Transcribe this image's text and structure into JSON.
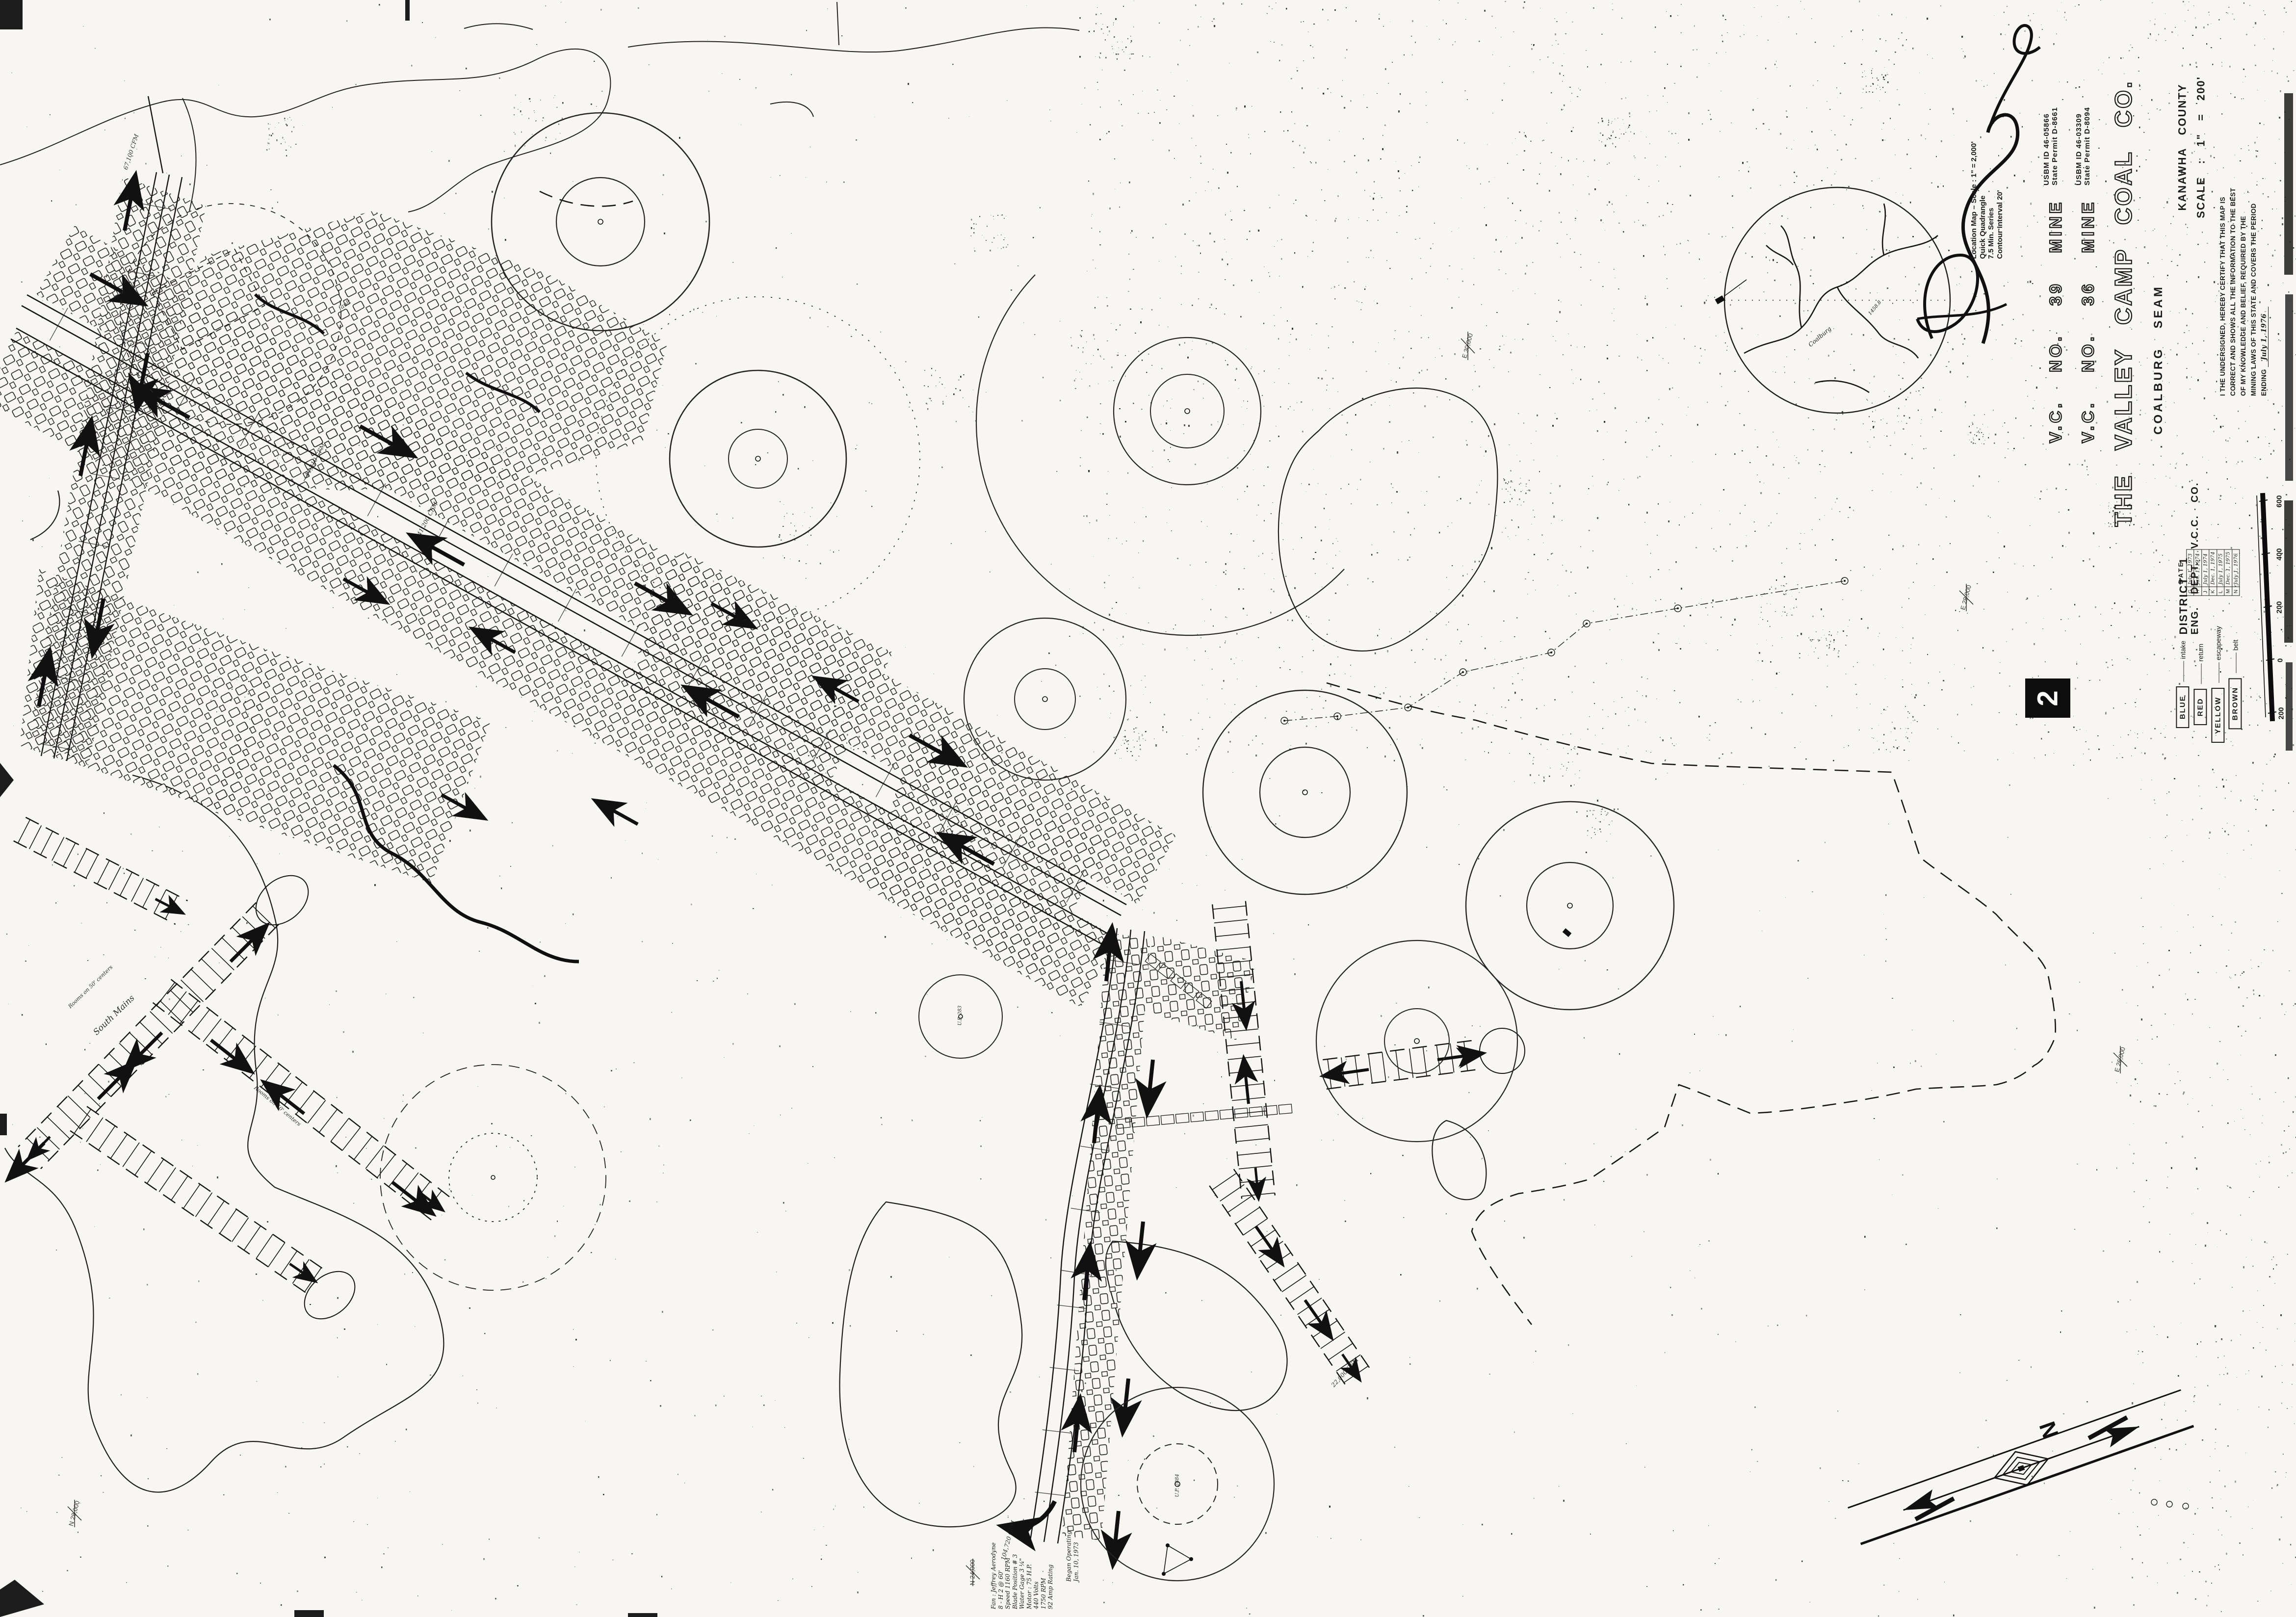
{
  "sheet": {
    "number": "2"
  },
  "title_block": {
    "mines": [
      {
        "name": "V.C.  NO. 39  MINE",
        "usbm_id": "USBM  ID  46-05866",
        "state_permit": "State Permit  D-8661"
      },
      {
        "name": "V.C.  NO. 36  MINE",
        "usbm_id": "USBM  ID  46-03309",
        "state_permit": "State Permit  D-8094"
      }
    ],
    "company": "THE  VALLEY  CAMP  COAL  CO.",
    "seam": "COALBURG   SEAM",
    "county": "KANAWHA   COUNTY",
    "scale": "SCALE : 1\" = 200'",
    "district": "DISTRICT   1",
    "department": "ENG.  DEPT.  V.C.C.  CO.",
    "certification": {
      "lines": [
        "I THE UNDERSIGNED, HEREBY CERTIFY THAT THIS MAP IS",
        "CORRECT AND SHOWS ALL THE INFORMATION TO THE BEST",
        "OF MY KNOWLEDGE AND BELIEF, REQUIRED BY THE",
        "MINING LAWS OF THIS STATE AND COVERS THE PERIOD",
        "ENDING"
      ],
      "ending_date": "July 1, 1976"
    }
  },
  "date_table": {
    "header": "DATE",
    "rows": [
      {
        "letter": "G",
        "date": "July 1, 1973"
      },
      {
        "letter": "H",
        "date": "Jan. 1, 1974"
      },
      {
        "letter": "J",
        "date": "July 1, 1974"
      },
      {
        "letter": "K",
        "date": "Dec. 1, 1974"
      },
      {
        "letter": "L",
        "date": "July 1, 1975"
      },
      {
        "letter": "M",
        "date": "Dec. 1, 1975"
      },
      {
        "letter": "N",
        "date": "July 1, 1976"
      }
    ]
  },
  "legend": {
    "items": [
      {
        "color": "BLUE",
        "meaning": "intake"
      },
      {
        "color": "RED",
        "meaning": "return"
      },
      {
        "color": "YELLOW",
        "meaning": "escapeway"
      },
      {
        "color": "BROWN",
        "meaning": "belt"
      }
    ]
  },
  "scale_bar": {
    "labels": [
      "600",
      "400",
      "200",
      "0",
      "200"
    ]
  },
  "north_arrow": {
    "label": "N"
  },
  "location_map": {
    "caption_lines": [
      "Location Map – Scale : 1\" = 2,000'",
      "Quick Quadrangle",
      "7.5 Min. Series",
      "Contour Interval  20'"
    ],
    "stream_label": "Coalburg",
    "elevation_label": "1458.8"
  },
  "map_annotations": {
    "grid_labels": [
      {
        "text": "E 30,000"
      },
      {
        "text": "E 28,000"
      },
      {
        "text": "E 26,000"
      },
      {
        "text": "N 28,000"
      },
      {
        "text": "N 24,000"
      }
    ],
    "airflow_labels": [
      {
        "text": "67,100 CFM"
      },
      {
        "text": "44,210 CFM"
      },
      {
        "text": "41,200 CFM"
      },
      {
        "text": "22,000 CFM"
      },
      {
        "text": "104,720 CFM"
      }
    ],
    "feature_labels": [
      {
        "text": "South Mains"
      },
      {
        "text": "Rooms on 50' centers"
      },
      {
        "text": "Rooms on 50' centers"
      },
      {
        "text": "fault"
      },
      {
        "text": "U.P. 283"
      },
      {
        "text": "U.P. 2884"
      }
    ],
    "fan_note_lines": [
      "Fan : Jeffrey Aerodyne",
      "8 - H  2 @ 60'",
      "Speed  1160 RPM",
      "Blade Position # 3",
      "Water Gage  3 ¼\"",
      "Motor : 75 H.P.",
      "440 Volts",
      "1750 RPM",
      "92 Amp Rating"
    ],
    "fan_status_lines": [
      "Began  Operating",
      "Jan. 10, 1973"
    ]
  }
}
